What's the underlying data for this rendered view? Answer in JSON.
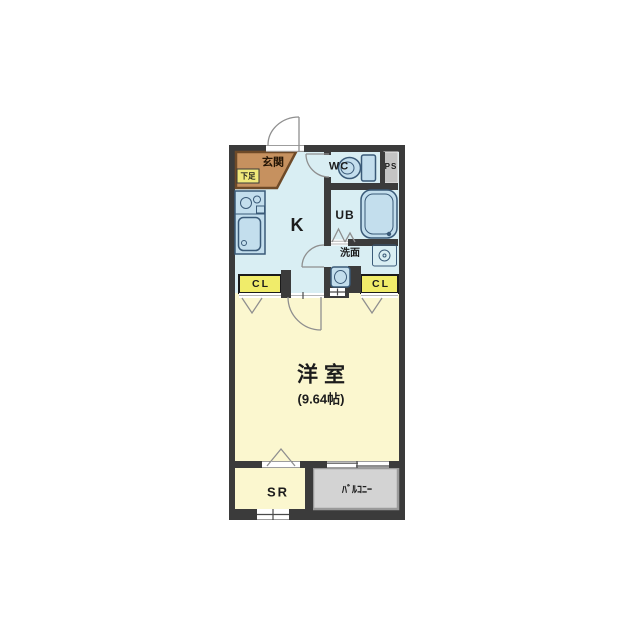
{
  "plan": {
    "kind": "apartment floor plan",
    "main_room_size_tatami": 9.64
  },
  "labels": {
    "genkan": "玄関",
    "shoe_box": "下足",
    "wc": "WC",
    "pipe_space": "PS",
    "kitchen": "K",
    "unit_bath": "UB",
    "washroom": "洗面",
    "closet_left": "CL",
    "closet_right": "CL",
    "main_room": "洋室",
    "main_room_size": "(9.64帖)",
    "storage": "SR",
    "balcony": "ﾊﾞﾙｺﾆｰ"
  },
  "fixtures": [
    "toilet",
    "bathtub",
    "kitchen-stove",
    "kitchen-sink",
    "wash-basin",
    "washing-machine-pan"
  ],
  "colors": {
    "background": "#ffffff",
    "wall": "#3b3b3b",
    "wet_floor": "#d9eef3",
    "room_floor": "#fbf7cf",
    "closet": "#f0ec6a",
    "shoe_box": "#f0e87a",
    "genkan": "#c6915f",
    "genkan_border": "#6e4a28",
    "pipe_space": "#c4c4c4",
    "balcony": "#d3d3d3",
    "balcony_border": "#9a9a9a",
    "fixture_fill": "#c3deed",
    "fixture_stroke": "#3a5a78",
    "door_line": "#8f8f8f"
  }
}
